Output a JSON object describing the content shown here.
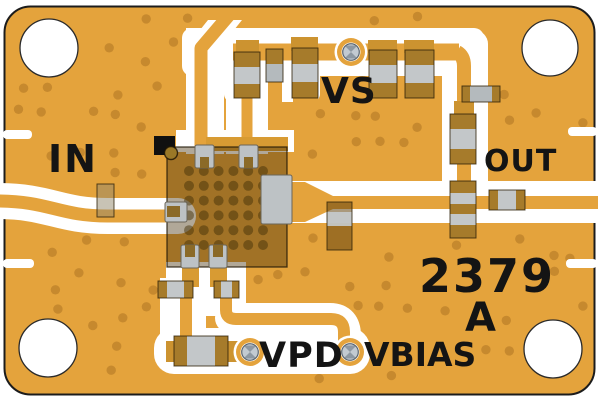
{
  "board": {
    "silkscreen_labels": {
      "input": "IN",
      "supply": "VS",
      "output": "OUT",
      "power_down": "VPD",
      "bias": "VBIAS",
      "part_number": "2379",
      "revision": "A"
    },
    "counts": {
      "mounting_holes": 4,
      "test_point_screws": 3
    },
    "colors": {
      "substrate": "#E4A33C",
      "via_dot": "#C6892E",
      "copper_pad": "#CC9330",
      "copper_bar": "#D89B33",
      "silkscreen": "#FFFFFF",
      "board_outline": "#1C1C1C",
      "label_text": "#141414",
      "component_body": "#A67B2B",
      "component_band": "#C3C7C9",
      "component_band_dim": "#B4BABD",
      "pin_gray": "#BDC2C5",
      "pin_notch": "#8B6A28",
      "chip_overlay": "rgba(68,48,10,0.42)",
      "chip_via": "rgba(70,50,8,0.5)",
      "marker_black": "#101010",
      "corner_via": "#9A7827",
      "screw_dark": "#8D98A2",
      "screw_light": "#C2CAD1"
    }
  }
}
